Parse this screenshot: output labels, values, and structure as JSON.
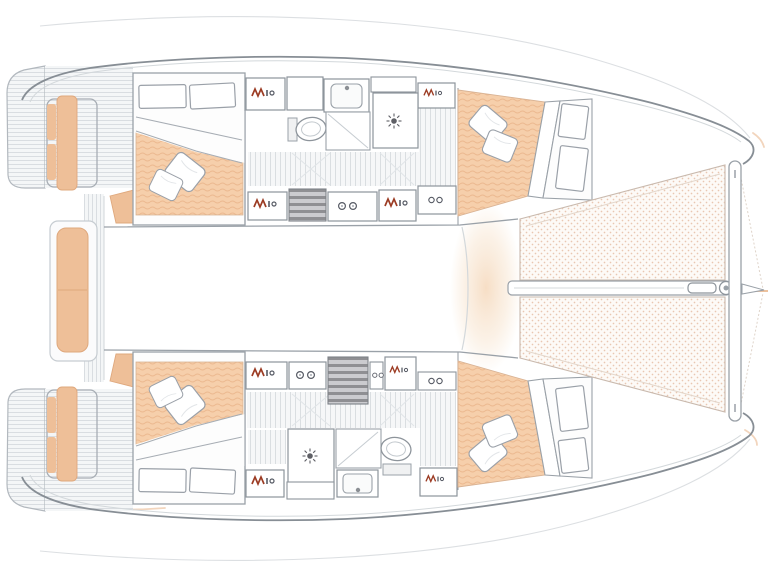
{
  "diagram": {
    "label": "Catamaran sailboat interior floor plan, bow to the right",
    "colors": {
      "outline": "#878e95",
      "wall": "#9aa1a8",
      "lightLine": "#d3d8db",
      "mattress": "#f6cfab",
      "mattressStripe": "#ecb98f",
      "cushion": "#eebf98",
      "cushionEdge": "#dfa87d",
      "plankLine": "#d6dbdf",
      "plankBg": "#f4f6f7",
      "floorLine": "#d3d8dc",
      "floorBg": "#f6f7f8",
      "trampDot": "#e9c7b2",
      "trampBg": "#fdfaf7",
      "trampEdge": "#c9b9ad",
      "glow": "#f6dcc2",
      "stepDark": "#8f8f93",
      "stepLight": "#cbcbcf",
      "glyphRed": "#9c3c24",
      "glyphDark": "#565a64",
      "accent": "#eab88f",
      "white": "#ffffff"
    },
    "features": {
      "cabins": 4,
      "bathrooms": 2,
      "showers": 2,
      "toilets": 2,
      "sinks": 2,
      "trampoline_panels": 2,
      "swim_platforms": 2,
      "cockpit_benches": 3,
      "pillows_per_cabin": 2
    }
  }
}
